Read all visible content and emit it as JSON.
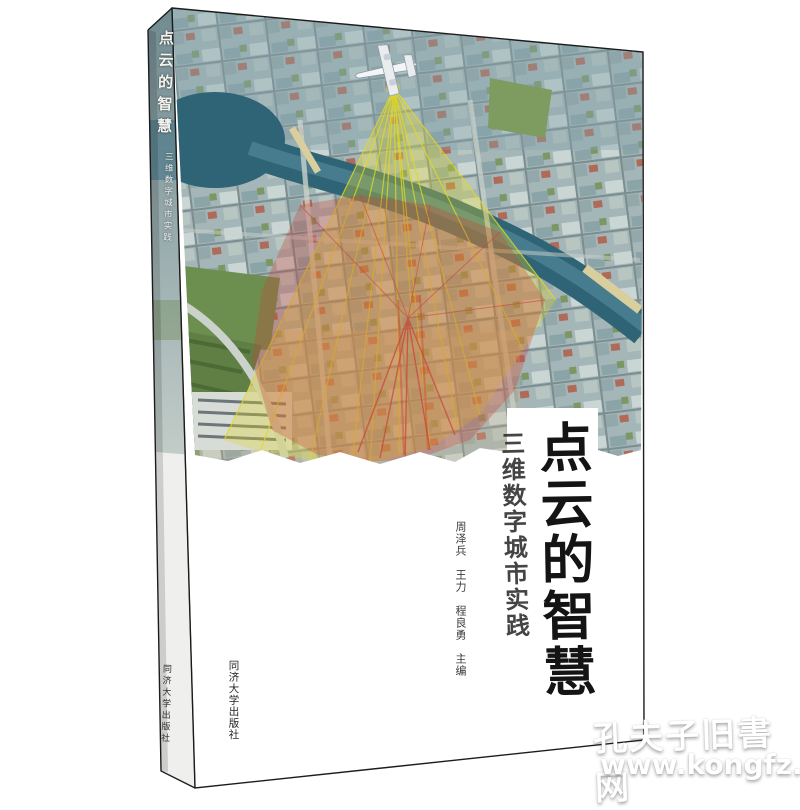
{
  "book": {
    "title": "点云的智慧",
    "subtitle": "三维数字城市实践",
    "authors": "周泽兵　王力　程良勇　主编",
    "publisher": "同济大学出版社",
    "spine": {
      "title": "点云的智慧",
      "subtitle": "三维数字城市实践",
      "publisher": "同济大学出版社"
    }
  },
  "watermark": {
    "line1": "孔夫子旧書网",
    "line2": "www.kongfz.com"
  },
  "icons": {
    "airplane": "survey-aircraft over city emitting lidar scan cone"
  },
  "colors": {
    "ink": "#141414",
    "cover_white": "#ffffff",
    "scan_yellow": "#e3d827",
    "scan_red": "#c8473a",
    "river_teal": "#2e6476",
    "city_base": "#a4b6b8",
    "watermark_white": "#ffffff"
  }
}
